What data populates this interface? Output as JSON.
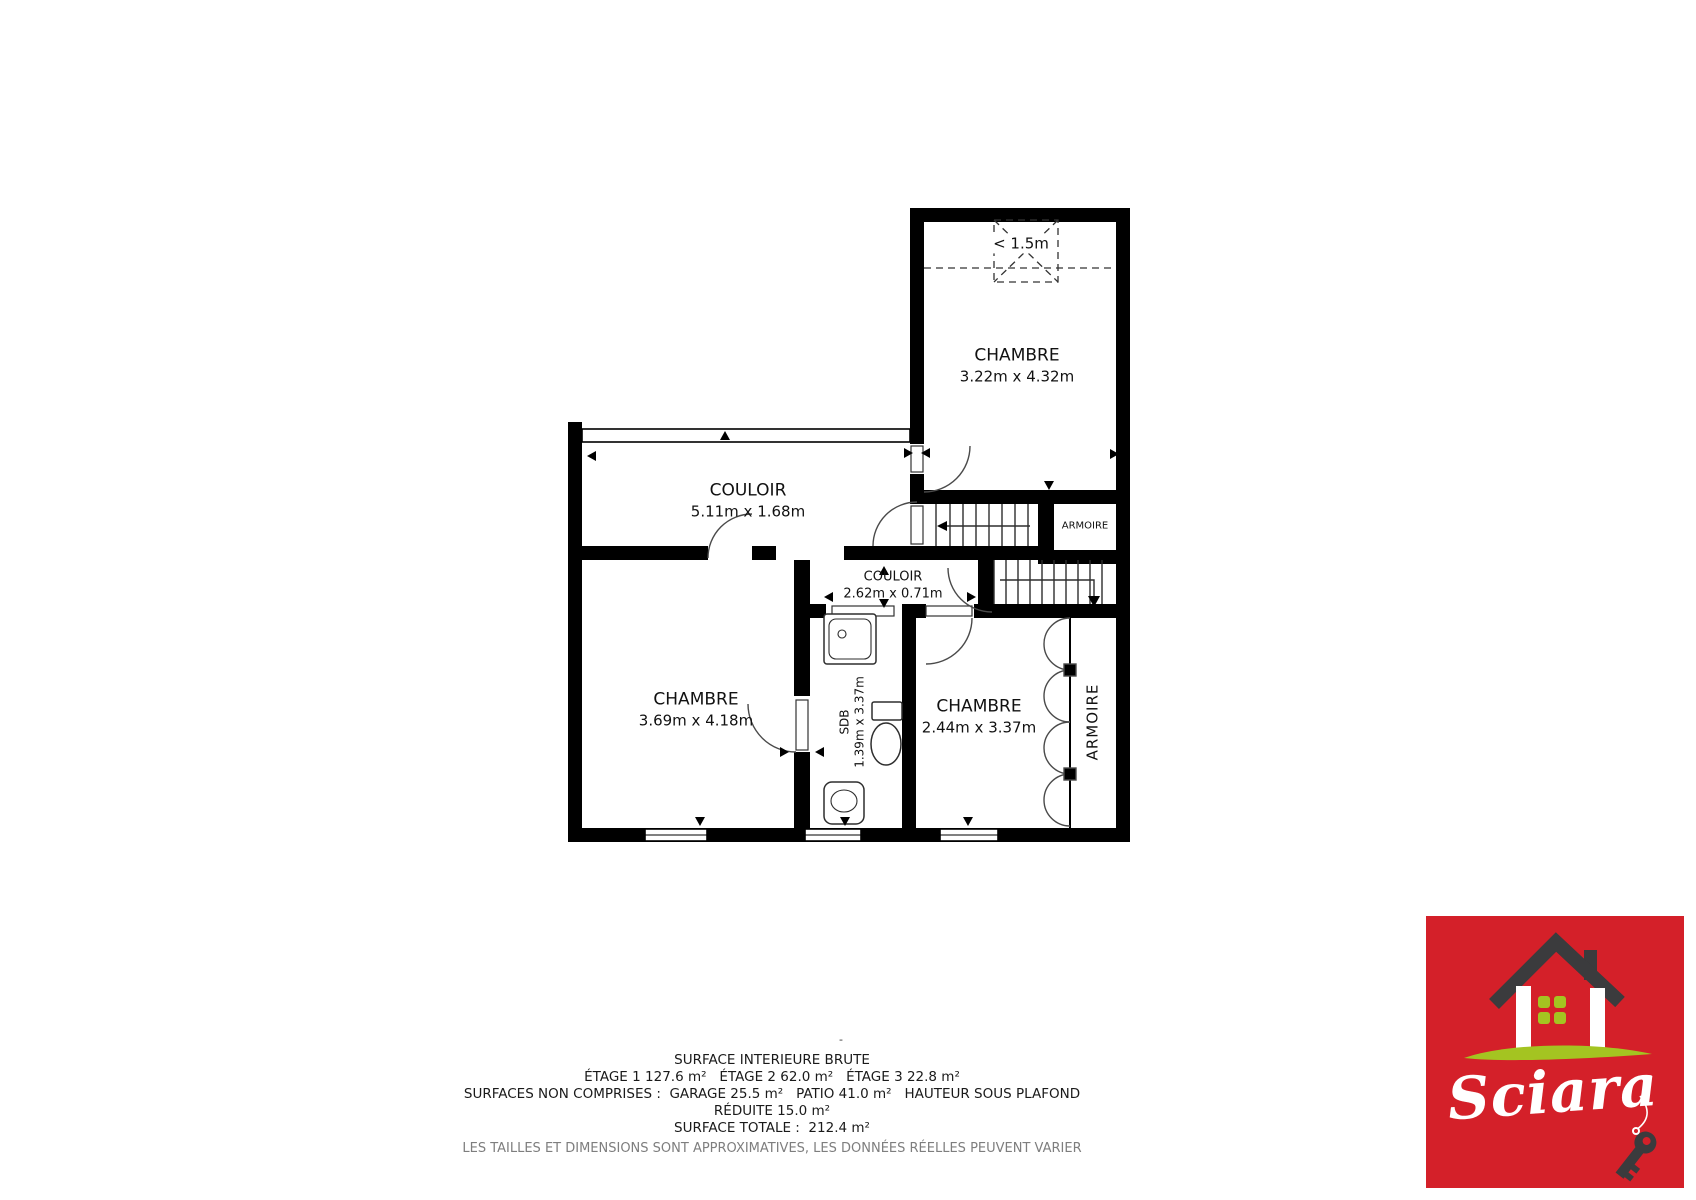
{
  "plan": {
    "rooms": [
      {
        "name": "CHAMBRE",
        "dims": "3.22m x 4.32m"
      },
      {
        "name": "COULOIR",
        "dims": "5.11m x 1.68m"
      },
      {
        "name": "COULOIR",
        "dims": "2.62m x 0.71m"
      },
      {
        "name": "CHAMBRE",
        "dims": "3.69m x 4.18m"
      },
      {
        "name": "SDB",
        "dims": "1.39m x 3.37m"
      },
      {
        "name": "CHAMBRE",
        "dims": "2.44m x 3.37m"
      }
    ],
    "closets": {
      "top": "ARMOIRE",
      "right": "ARMOIRE"
    },
    "low_ceiling_label": "< 1.5m",
    "center_dash": "-"
  },
  "summary": {
    "title": "SURFACE INTERIEURE BRUTE",
    "floors": "ÉTAGE 1 127.6 m²   ÉTAGE 2 62.0 m²   ÉTAGE 3 22.8 m²",
    "excluded_line1": "SURFACES NON COMPRISES :  GARAGE 25.5 m²   PATIO 41.0 m²   HAUTEUR SOUS PLAFOND",
    "excluded_line2": "RÉDUITE 15.0 m²",
    "total": "SURFACE TOTALE :  212.4 m²",
    "disclaimer": "LES TAILLES ET DIMENSIONS SONT APPROXIMATIVES, LES DONNÉES RÉELLES PEUVENT VARIER"
  },
  "logo": {
    "brand": "Sciara",
    "colors": {
      "background": "#d42029",
      "roof": "#3b3b3d",
      "accent_green": "#a4c421"
    }
  }
}
